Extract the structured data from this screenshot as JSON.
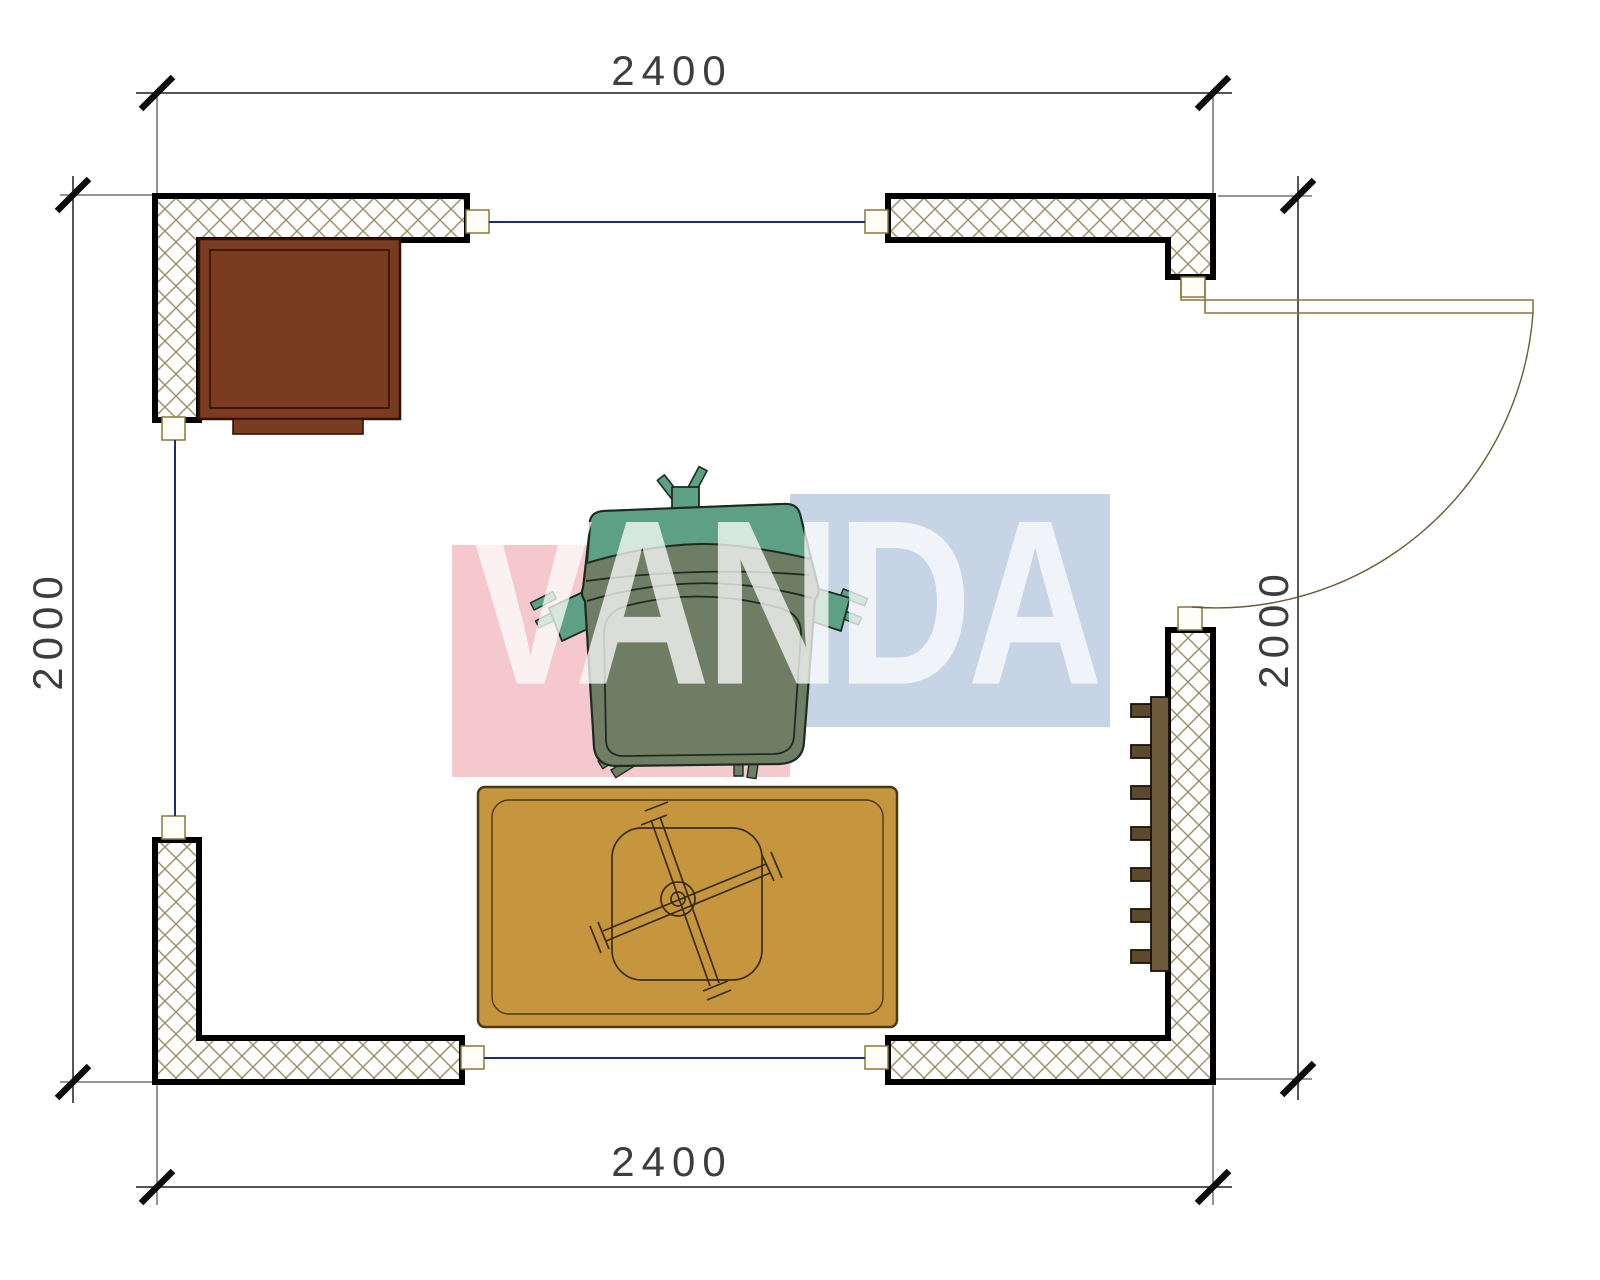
{
  "drawing": {
    "type": "floor-plan"
  },
  "dimensions": {
    "top": "2400",
    "bottom": "2400",
    "left": "2000",
    "right": "2000"
  },
  "watermark": {
    "text": "VANDA",
    "text_color": "#ffffff",
    "block_pink": "#f5c8ce",
    "block_blue": "#c6d4e6"
  },
  "colors": {
    "wall_outline": "#000000",
    "hatch_line": "#9b8b62",
    "window_line": "#1c2f6b",
    "door_line": "#8a763c",
    "cabinet": "#7b3b1f",
    "cabinet_outline": "#2e1205",
    "rug": "#c6963e",
    "rug_outline": "#4a3a12",
    "table_line": "#3a2c12",
    "chair_seat": "#6f7d64",
    "chair_back": "#5da085",
    "chair_outline": "#1c2b20",
    "radiator": "#6f5b3b",
    "radiator_fin": "#5d4a2e",
    "dimension_text": "#3d3d3d"
  }
}
